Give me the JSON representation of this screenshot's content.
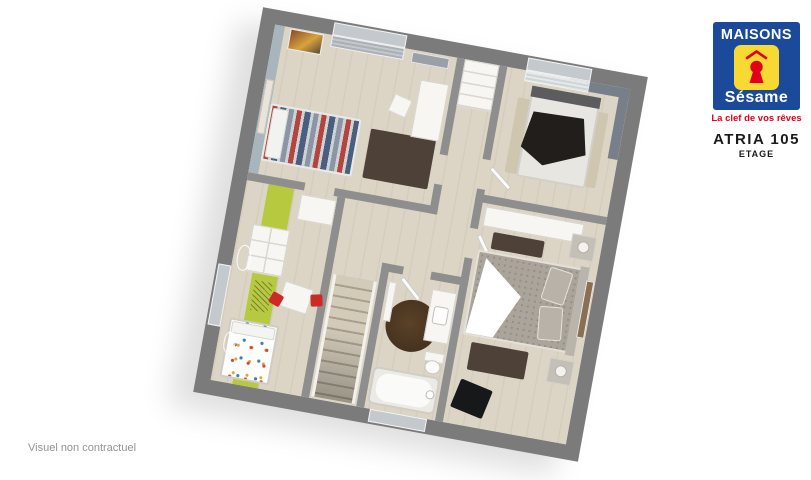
{
  "branding": {
    "logo_line1": "MAISONS",
    "logo_line2": "Sésame",
    "tagline": "La clef de vos rêves",
    "model_name": "ATRIA 105",
    "floor_label": "ETAGE",
    "colors": {
      "blue": "#1b4a9b",
      "yellow": "#f8d832",
      "red": "#e2001a"
    }
  },
  "footer": {
    "disclaimer": "Visuel non contractuel"
  },
  "floorplan": {
    "rotation_deg": 10.3,
    "rooms": [
      "bedroom-1",
      "bedroom-2",
      "kids-bedroom",
      "master-bedroom",
      "bathroom",
      "hallway",
      "staircase"
    ],
    "colors": {
      "outer_wall": "#7b7b7b",
      "inner_wall": "#8e8e8e",
      "floor": "#dcd5c6",
      "accent_blue_gray": "#a9b5bc",
      "accent_lime": "#b7c93e",
      "accent_dark": "#77808a",
      "rug_dark": "#4e4238",
      "rug_round": "#46321f"
    }
  }
}
